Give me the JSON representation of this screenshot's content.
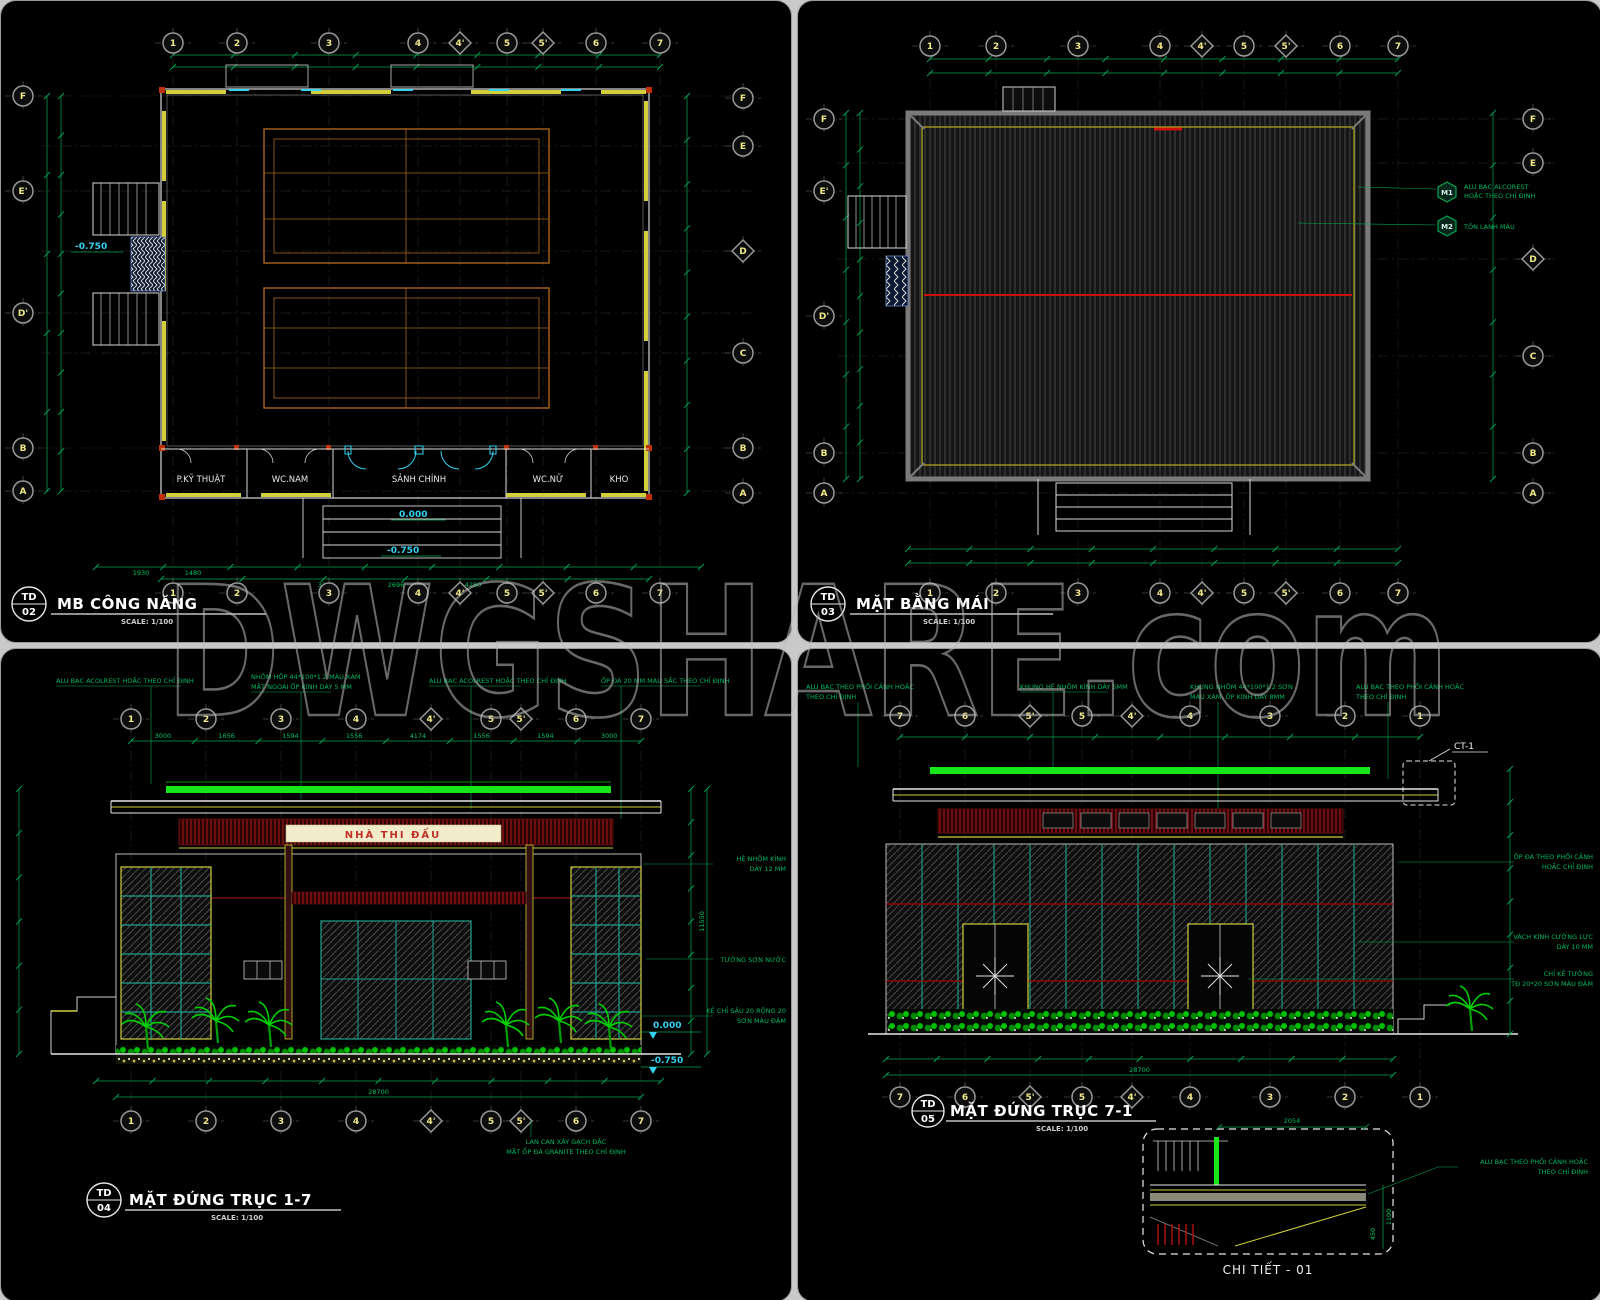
{
  "watermark": "DWGSHARE.com",
  "colors": {
    "dim_green": "#00a651",
    "bright_green": "#19e619",
    "cyan": "#35d2f2",
    "wall_yellow": "#d2cf3a",
    "maroon": "#8a1515",
    "cream": "#f2eccb",
    "sign_red": "#c03028",
    "court_orange": "#a8651e",
    "teal": "#1fa08c",
    "bubble_text": "#efe98a",
    "plant_green": "#00d000",
    "roof_gray": "#7a7a7a"
  },
  "floor_plan": {
    "code_line1": "TD",
    "code_line2": "02",
    "title": "MB CÔNG NĂNG",
    "scale": "SCALE: 1/100",
    "grid_cols": [
      "1",
      "2",
      "3",
      "4",
      "4'",
      "5",
      "5'",
      "6",
      "7"
    ],
    "grid_left": [
      "F",
      "E'",
      "D'",
      "B",
      "A"
    ],
    "grid_right": [
      "F",
      "E",
      "D",
      "C",
      "B",
      "A"
    ],
    "rooms": [
      "P.KỸ THUẬT",
      "WC.NAM",
      "SẢNH CHÍNH",
      "WC.NỮ",
      "KHO"
    ],
    "level_main": "0.000",
    "level_entry": "-0.750",
    "level_left": "-0.750",
    "loose_dims": [
      "1930",
      "1480",
      "3250",
      "2696",
      "4280"
    ]
  },
  "roof_plan": {
    "code_line1": "TD",
    "code_line2": "03",
    "title": "MẶT BẰNG MÁI",
    "scale": "SCALE: 1/100",
    "grid_cols": [
      "1",
      "2",
      "3",
      "4",
      "4'",
      "5",
      "5'",
      "6",
      "7"
    ],
    "grid_left": [
      "F",
      "E'",
      "D'",
      "B",
      "A"
    ],
    "grid_right": [
      "F",
      "E",
      "D",
      "C",
      "B",
      "A"
    ],
    "materials": [
      {
        "tag": "M1",
        "line1": "ALU BẠC ALCOREST",
        "line2": "HOẶC THEO CHỈ ĐỊNH"
      },
      {
        "tag": "M2",
        "line1": "TÔN LẠNH MÀU",
        "line2": ""
      }
    ]
  },
  "front_elevation": {
    "code_line1": "TD",
    "code_line2": "04",
    "title": "MẶT ĐỨNG TRỤC 1-7",
    "scale": "SCALE: 1/100",
    "grid_cols": [
      "1",
      "2",
      "3",
      "4",
      "4'",
      "5",
      "5'",
      "6",
      "7"
    ],
    "dims_top": [
      "3000",
      "1656",
      "1594",
      "1556",
      "4174",
      "1556",
      "1594",
      "3000"
    ],
    "dims_total_w": [
      "28700"
    ],
    "dims_total_h": [
      "11550"
    ],
    "sign_text": "NHÀ THI ĐẤU",
    "level_zero": "0.000",
    "level_minus": "-0.750",
    "notes_top": [
      [
        "ALU BẠC ACOLREST HOẶC THEO CHỈ ĐỊNH",
        ""
      ],
      [
        "NHÔM HỘP 44*100*1.2 MÀU XÁM",
        "MẶT NGOÀI ỐP KÍNH DÀY 5 MM"
      ],
      [
        "ALU BẠC ACOLREST HOẶC THEO CHỈ ĐỊNH",
        ""
      ],
      [
        "ỐP ĐÁ 20 MM MÀU SẮC THEO CHỈ ĐỊNH",
        ""
      ]
    ],
    "notes_right": [
      [
        "HỆ NHÔM KÍNH",
        "DÀY 12 MM"
      ],
      [
        "TƯỜNG SƠN NƯỚC",
        ""
      ],
      [
        "KẺ CHỈ SÂU 20 RỘNG 20",
        "SƠN MÀU ĐẬM"
      ]
    ],
    "note_bottom": [
      "LAN CAN XÂY GẠCH ĐẶC",
      "MẶT ỐP ĐÁ GRANITE THEO CHỈ ĐỊNH"
    ]
  },
  "rear_elevation": {
    "code_line1": "TD",
    "code_line2": "05",
    "title": "MẶT ĐỨNG TRỤC 7-1",
    "scale": "SCALE: 1/100",
    "grid_cols": [
      "7",
      "6",
      "5'",
      "5",
      "4'",
      "4",
      "3",
      "2",
      "1"
    ],
    "dims_total_w": [
      "28700"
    ],
    "callout": "CT-1",
    "notes_top": [
      [
        "ALU BẠC THEO PHỐI CẢNH HOẶC",
        "THEO CHỈ ĐỊNH"
      ],
      [
        "KHUNG HỆ NHÔM KÍNH DÀY 5MM",
        ""
      ],
      [
        "KHUNG NHÔM 44*100*1.2 SƠN",
        "MÀU XÁM, ỐP KÍNH DÀY 8MM"
      ],
      [
        "ALU BẠC THEO PHỐI CẢNH HOẶC",
        "THEO CHỈ ĐỊNH"
      ]
    ],
    "notes_right": [
      [
        "ỐP ĐÁ THEO PHỐI CẢNH",
        "HOẶC CHỈ ĐỊNH"
      ],
      [
        "VÁCH KÍNH CƯỜNG LỰC",
        "DÀY 10 MM"
      ],
      [
        "CHỈ KẺ TƯỜNG",
        "TĐ 20*20 SƠN MÀU ĐẬM"
      ]
    ],
    "detail": {
      "title": "CHI TIẾT - 01",
      "dim_top": "2054",
      "dim_side1": "1100",
      "dim_side2": "450",
      "note": [
        "ALU BẠC THEO PHỐI CẢNH HOẶC",
        "THEO CHỈ ĐỊNH"
      ]
    }
  }
}
